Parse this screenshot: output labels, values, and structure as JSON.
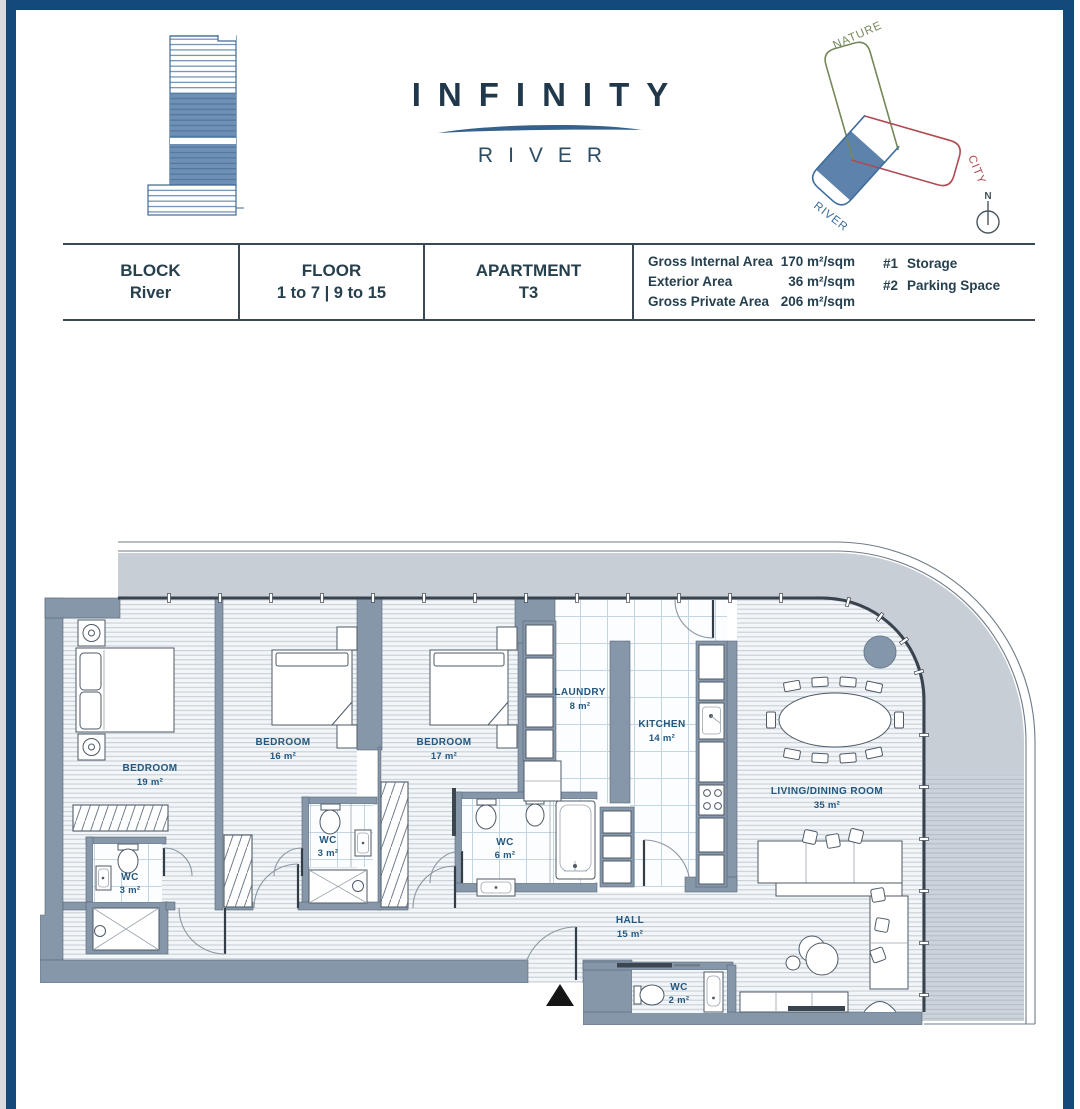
{
  "brand": {
    "name": "INFINITY",
    "line": "RIVER"
  },
  "orientation": {
    "nature": "NATURE",
    "city": "CITY",
    "river": "RIVER",
    "north": "N"
  },
  "colors": {
    "frame": "#114a7b",
    "wing_nature": "#75885a",
    "wing_city": "#b04a52",
    "wing_river": "#3e6d9c",
    "highlight": "#5d83ac",
    "wall": "#8697aa",
    "label": "#24587f"
  },
  "info_table": {
    "block": {
      "label": "BLOCK",
      "value": "River"
    },
    "floor": {
      "label": "FLOOR",
      "value": "1 to 7 | 9 to 15"
    },
    "apartment": {
      "label": "APARTMENT",
      "value": "T3"
    },
    "areas": [
      {
        "label": "Gross Internal Area",
        "value": "170 m²/sqm"
      },
      {
        "label": "Exterior Area",
        "value": "36 m²/sqm"
      },
      {
        "label": "Gross Private Area",
        "value": "206 m²/sqm"
      }
    ],
    "extras": [
      {
        "num": "#1",
        "label": "Storage"
      },
      {
        "num": "#2",
        "label": "Parking Space"
      }
    ]
  },
  "floor_plan": {
    "bedroom1": {
      "name": "BEDROOM",
      "area": "19 m²"
    },
    "bedroom2": {
      "name": "BEDROOM",
      "area": "16 m²"
    },
    "bedroom3": {
      "name": "BEDROOM",
      "area": "17 m²"
    },
    "laundry": {
      "name": "LAUNDRY",
      "area": "8 m²"
    },
    "kitchen": {
      "name": "KITCHEN",
      "area": "14 m²"
    },
    "wc_bedroom1": {
      "name": "WC",
      "area": "3 m²"
    },
    "wc_bedroom2": {
      "name": "WC",
      "area": "3 m²"
    },
    "wc_main": {
      "name": "WC",
      "area": "6 m²"
    },
    "wc_guest": {
      "name": "WC",
      "area": "2 m²"
    },
    "hall": {
      "name": "HALL",
      "area": "15 m²"
    },
    "living": {
      "name": "LIVING/DINING ROOM",
      "area": "35 m²"
    }
  }
}
